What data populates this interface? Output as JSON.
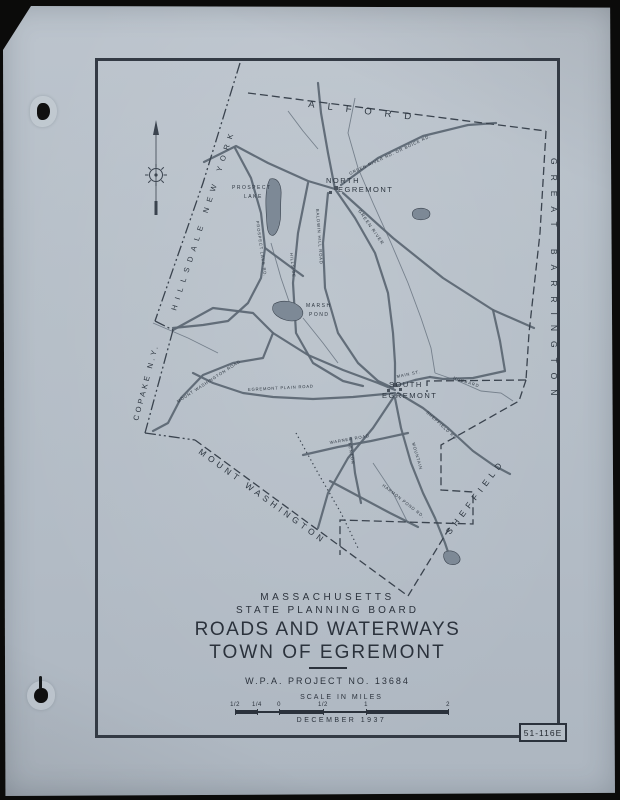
{
  "colors": {
    "paper": "#b5bec7",
    "ink": "#2d3640",
    "road": "#5d6874",
    "water": "#6e7985",
    "boundary": "#3a434e"
  },
  "sheet": {
    "number": "51-116E"
  },
  "title_block": {
    "state": "MASSACHUSETTS",
    "agency": "STATE PLANNING BOARD",
    "title": "ROADS AND WATERWAYS",
    "subtitle": "TOWN OF EGREMONT",
    "project": "W.P.A. PROJECT NO. 13684",
    "scale_label": "SCALE IN MILES",
    "date": "DECEMBER 1937"
  },
  "scale_bar": {
    "tick_labels": [
      "1/2",
      "1/4",
      "0",
      "1/2",
      "1",
      "2"
    ],
    "tick_positions": [
      0,
      0.103,
      0.207,
      0.413,
      0.615,
      1
    ]
  },
  "map": {
    "boundaries": [
      {
        "name": "state-line-hillsdale",
        "style": "state",
        "d": "M142,2 L105,122 L57,260"
      },
      {
        "name": "state-line-jog-north",
        "style": "state",
        "d": "M57,260 L75,269"
      },
      {
        "name": "state-line-copake",
        "style": "state",
        "d": "M75,269 L47,372"
      },
      {
        "name": "state-line-jog-south",
        "style": "state",
        "d": "M47,372 L97,379"
      },
      {
        "name": "town-line-mount-washington",
        "style": "town",
        "d": "M97,379 L310,535"
      },
      {
        "name": "town-line-alford",
        "style": "town",
        "d": "M150,32 L448,70"
      },
      {
        "name": "town-line-great-barrington",
        "style": "town",
        "d": "M448,70 L442,172 L431,272 L428,319"
      },
      {
        "name": "town-line-sheffield-notch",
        "style": "town",
        "d": "M428,319 L329,320 L329,331"
      },
      {
        "name": "town-line-sheffield-steps",
        "style": "town",
        "d": "M428,319 L421,340 L343,384 L343,429 L375,431 L375,463 L242,459 L242,494"
      },
      {
        "name": "town-line-south-corner",
        "style": "town",
        "d": "M310,535 L352,466"
      }
    ],
    "roads": [
      {
        "name": "northwest-entry-road",
        "d": "M106,101 L138,85 L170,102 L210,120 L237,128"
      },
      {
        "name": "trunk-road-north",
        "d": "M237,128 L257,157 L277,192 L290,232 L295,272 L297,302 L297,325"
      },
      {
        "name": "alford-road",
        "d": "M220,22 L223,52 L230,92 L237,128"
      },
      {
        "name": "green-river-road",
        "d": "M243,124 L280,97 L325,75 L370,64 L398,62"
      },
      {
        "name": "great-barrington-road",
        "d": "M245,132 L295,177 L345,217 L395,249 L436,267"
      },
      {
        "name": "baldwin-hill-road",
        "d": "M230,132 L225,182 L227,227 L240,272 L260,302 L280,320 L295,327"
      },
      {
        "name": "hillside-road",
        "d": "M210,122 L200,172 L195,222 L198,272 L215,302 L245,320 L265,325"
      },
      {
        "name": "prospect-lake-road",
        "d": "M137,87 L153,117 L163,152 L167,187 L163,217 L150,242 L130,260 L105,264 L75,267"
      },
      {
        "name": "lake-east-connector",
        "d": "M167,187 L190,204 L205,215"
      },
      {
        "name": "mount-washington-road",
        "d": "M75,269 L115,247 L155,252 L175,272 L165,297 L135,302 L105,314 L83,337 L70,362 L55,370"
      },
      {
        "name": "mount-washington-road-east",
        "d": "M175,272 L210,294 L245,309 L280,322 L297,329"
      },
      {
        "name": "egremont-plain-road",
        "d": "M297,332 L255,336 L215,338 L175,336 L145,332 L115,322 L95,312"
      },
      {
        "name": "main-street",
        "d": "M297,325 L317,319 L332,316"
      },
      {
        "name": "east-village-road",
        "d": "M395,249 L402,280 L407,310 L375,317 L345,318 L332,316"
      },
      {
        "name": "sheffield-road",
        "d": "M300,332 L325,347 L350,367 L375,390 L395,404 L412,413"
      },
      {
        "name": "mountain-road",
        "d": "M297,337 L303,367 L313,402 L325,432 L337,457 L347,482 L353,500"
      },
      {
        "name": "southwest-road",
        "d": "M297,334 L275,367 L250,397 L230,432 L220,467"
      },
      {
        "name": "warner-road",
        "d": "M205,394 L240,386 L273,380 L310,372"
      },
      {
        "name": "fenton-road",
        "d": "M253,377 L257,412 L263,442"
      },
      {
        "name": "harmon-pond-road",
        "d": "M232,420 L262,436 L292,452 L320,466"
      }
    ],
    "waterways": [
      {
        "name": "green-river",
        "d": "M257,37 L250,72 L260,107 L275,142 L293,182 L310,222 L323,257 L333,287 L337,312"
      },
      {
        "name": "karner-brook",
        "d": "M173,182 L183,217 L195,252"
      },
      {
        "name": "hubbard-brook",
        "d": "M337,312 L360,320 L383,330 L403,332 L415,340"
      },
      {
        "name": "west-brook",
        "d": "M55,262 L90,277 L120,292"
      },
      {
        "name": "south-brook",
        "d": "M275,402 L295,432 L310,462"
      },
      {
        "name": "marsh-pond-brook",
        "d": "M205,257 L225,282 L240,302"
      },
      {
        "name": "north-brook",
        "d": "M190,50 L205,70 L220,88"
      }
    ],
    "trails": [
      {
        "name": "dotted-trail",
        "d": "M198,372 L220,412 L243,452 L260,487"
      }
    ],
    "ponds": [
      {
        "name": "prospect-lake-pond",
        "d": "M172,118 C180,116 184,124 183,136 C182,150 184,158 180,168 C176,178 170,176 169,164 C168,150 166,128 172,118 Z"
      },
      {
        "name": "marsh-pond-pond",
        "d": "M176,243 C184,238 196,240 202,246 C208,252 204,260 194,260 C184,260 170,252 176,243 Z"
      },
      {
        "name": "boundary-pond",
        "d": "M318,148 C324,146 332,148 332,153 C332,158 324,160 318,158 C313,156 313,150 318,148 Z"
      },
      {
        "name": "harmon-pond",
        "d": "M347,491 C353,488 360,491 362,497 C363,502 357,505 351,503 C346,501 344,494 347,491 Z"
      }
    ],
    "village_blocks": [
      {
        "x": 236,
        "y": 125,
        "w": 4,
        "h": 4
      },
      {
        "x": 231,
        "y": 130,
        "w": 3,
        "h": 3
      },
      {
        "x": 295,
        "y": 322,
        "w": 4,
        "h": 4
      },
      {
        "x": 301,
        "y": 327,
        "w": 3,
        "h": 3
      },
      {
        "x": 289,
        "y": 328,
        "w": 3,
        "h": 3
      }
    ],
    "labels": [
      {
        "name": "label-alford",
        "text": "ALFORD",
        "x": 210,
        "y": 46,
        "rotate": 7,
        "size": 9.5,
        "ls": 13
      },
      {
        "name": "label-great-barrington",
        "text": "GREAT  BARRINGTON",
        "x": 453,
        "y": 97,
        "rotate": 90,
        "size": 8.5,
        "ls": 10
      },
      {
        "name": "label-sheffield",
        "text": "SHEFFIELD",
        "x": 352,
        "y": 474,
        "rotate": -53,
        "size": 8.5,
        "ls": 5
      },
      {
        "name": "label-mount-washington",
        "text": "MOUNT  WASHINGTON",
        "x": 100,
        "y": 392,
        "rotate": 36,
        "size": 8.5,
        "ls": 4
      },
      {
        "name": "label-hillsdale-new-york",
        "text": "HILLSDALE NEW YORK",
        "x": 78,
        "y": 250,
        "rotate": -72,
        "size": 7.5,
        "ls": 6
      },
      {
        "name": "label-copake-ny",
        "text": "COPAKE N.Y.",
        "x": 40,
        "y": 360,
        "rotate": -75,
        "size": 7.5,
        "ls": 3
      },
      {
        "name": "label-north-egremont-1",
        "text": "NORTH",
        "x": 228,
        "y": 122,
        "rotate": 0,
        "size": 7.5,
        "ls": 1.5
      },
      {
        "name": "label-north-egremont-2",
        "text": "EGREMONT",
        "x": 240,
        "y": 131,
        "rotate": 0,
        "size": 7.5,
        "ls": 1.5
      },
      {
        "name": "label-south-egremont-1",
        "text": "SOUTH",
        "x": 291,
        "y": 326,
        "rotate": 0,
        "size": 7.5,
        "ls": 1.5
      },
      {
        "name": "label-south-egremont-2",
        "text": "EGREMONT",
        "x": 284,
        "y": 337,
        "rotate": 0,
        "size": 7.5,
        "ls": 1.5
      },
      {
        "name": "label-prospect-lake-1",
        "text": "PROSPECT",
        "x": 134,
        "y": 128,
        "rotate": 0,
        "size": 5,
        "ls": 1.5
      },
      {
        "name": "label-prospect-lake-2",
        "text": "LAKE",
        "x": 146,
        "y": 137,
        "rotate": 0,
        "size": 5,
        "ls": 1.5
      },
      {
        "name": "label-marsh-pond-1",
        "text": "MARSH",
        "x": 208,
        "y": 246,
        "rotate": 0,
        "size": 5,
        "ls": 1.5
      },
      {
        "name": "label-marsh-pond-2",
        "text": "POND",
        "x": 211,
        "y": 255,
        "rotate": 0,
        "size": 5,
        "ls": 1.5
      },
      {
        "name": "label-green-river",
        "text": "GREEN RIVER",
        "x": 260,
        "y": 150,
        "rotate": 55,
        "size": 4.5,
        "ls": 1
      },
      {
        "name": "label-hubbard-brook",
        "text": "HUBBARD",
        "x": 355,
        "y": 318,
        "rotate": 18,
        "size": 4.2,
        "ls": 1
      },
      {
        "name": "label-green-river-road",
        "text": "GREEN RIVER RD. OR BOICE RD.",
        "x": 252,
        "y": 114,
        "rotate": -25,
        "size": 4.2,
        "ls": 0.8
      },
      {
        "name": "label-baldwin-hill-road",
        "text": "BALDWIN HILL ROAD",
        "x": 218,
        "y": 148,
        "rotate": 86,
        "size": 4.2,
        "ls": 0.8
      },
      {
        "name": "label-hillside-road",
        "text": "HILLSIDE",
        "x": 192,
        "y": 192,
        "rotate": 84,
        "size": 4.2,
        "ls": 0.8
      },
      {
        "name": "label-prospect-lake-road",
        "text": "PROSPECT LAKE RD.",
        "x": 158,
        "y": 160,
        "rotate": 82,
        "size": 4.2,
        "ls": 0.8
      },
      {
        "name": "label-mount-washington-road",
        "text": "MOUNT WASHINGTON ROAD",
        "x": 80,
        "y": 342,
        "rotate": -33,
        "size": 4.2,
        "ls": 0.8
      },
      {
        "name": "label-egremont-plain-road",
        "text": "EGREMONT PLAIN ROAD",
        "x": 150,
        "y": 330,
        "rotate": -3,
        "size": 4.2,
        "ls": 0.8
      },
      {
        "name": "label-main-street",
        "text": "MAIN ST.",
        "x": 299,
        "y": 317,
        "rotate": -12,
        "size": 4.2,
        "ls": 0.8
      },
      {
        "name": "label-sheffield-road",
        "text": "SHEFFIELD RD.",
        "x": 328,
        "y": 352,
        "rotate": 42,
        "size": 4.2,
        "ls": 0.8
      },
      {
        "name": "label-warner-road",
        "text": "WARNER ROAD",
        "x": 232,
        "y": 383,
        "rotate": -10,
        "size": 4.2,
        "ls": 0.8
      },
      {
        "name": "label-mountain-road",
        "text": "MOUNTAIN",
        "x": 314,
        "y": 382,
        "rotate": 74,
        "size": 4.2,
        "ls": 0.8
      },
      {
        "name": "label-fenton-road",
        "text": "FENTON",
        "x": 250,
        "y": 382,
        "rotate": 80,
        "size": 4.2,
        "ls": 0.8
      },
      {
        "name": "label-harmon-pond-road",
        "text": "HARMON POND RD.",
        "x": 284,
        "y": 425,
        "rotate": 38,
        "size": 4.2,
        "ls": 0.8
      }
    ]
  }
}
